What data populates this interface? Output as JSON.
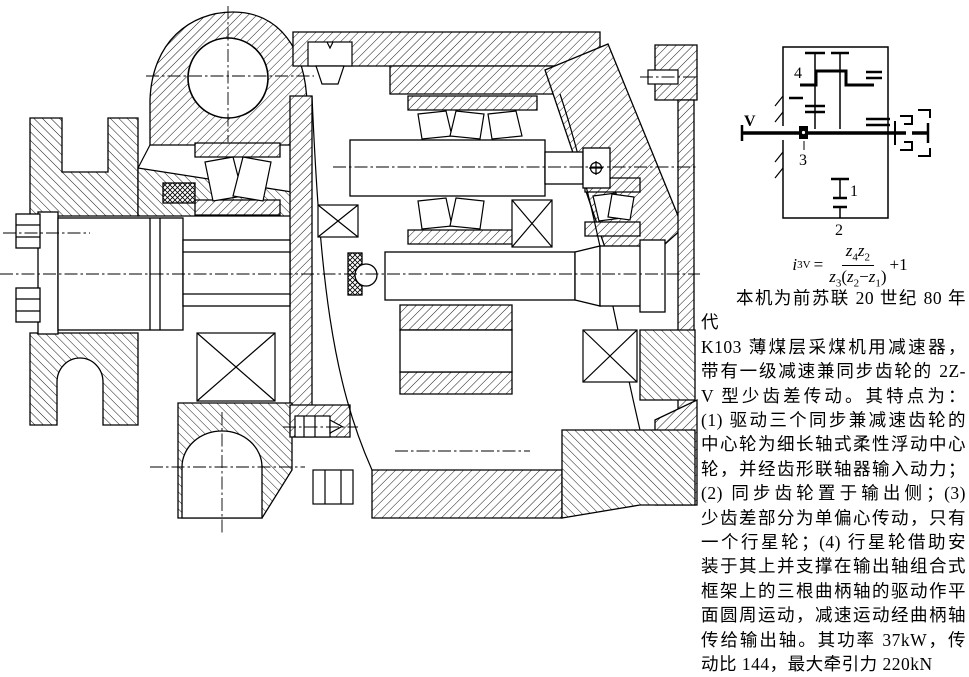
{
  "colors": {
    "ink": "#000000",
    "paper": "#ffffff"
  },
  "schematic": {
    "labels": {
      "input_shaft": "V",
      "gear4": "4",
      "gear3": "3",
      "gear1": "1",
      "gear2": "2"
    }
  },
  "formula": {
    "lhs": "i",
    "lhs_sub": "3V",
    "equals": "=",
    "n1": "z",
    "n1s": "4",
    "n2": "z",
    "n2s": "2",
    "d1": "z",
    "d1s": "3",
    "dp1": "(",
    "d2": "z",
    "d2s": "2",
    "dm": "−",
    "d3": "z",
    "d3s": "1",
    "dp2": ")",
    "tail": "+1"
  },
  "description": {
    "lines": [
      "本机为前苏联 20 世纪 80 年代",
      "K103 薄煤层采煤机用减速器，",
      "带有一级减速兼同步齿轮的 2Z-",
      "V 型少齿差传动。其特点为：",
      "(1) 驱动三个同步兼减速齿轮的",
      "中心轮为细长轴式柔性浮动中心",
      "轮，并经齿形联轴器输入动力；",
      "(2) 同步齿轮置于输出侧；(3)",
      "少齿差部分为单偏心传动，只有",
      "一个行星轮；(4) 行星轮借助安",
      "装于其上并支撑在输出轴组合式",
      "框架上的三根曲柄轴的驱动作平",
      "面圆周运动，减速运动经曲柄轴",
      "传给输出轴。其功率 37kW，传",
      "动比 144，最大牵引力 220kN"
    ]
  }
}
